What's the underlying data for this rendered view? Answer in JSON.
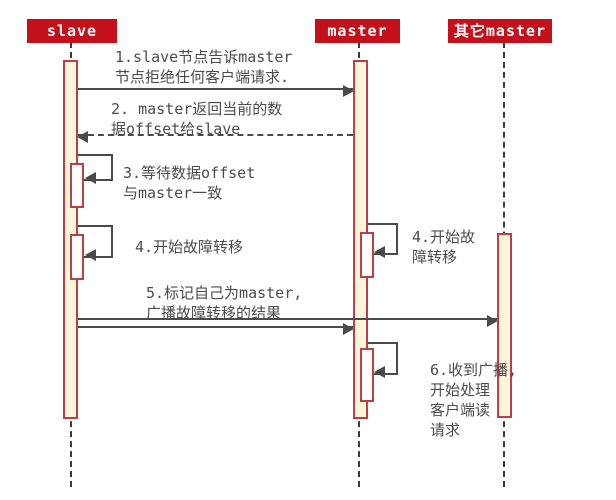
{
  "diagram": {
    "kind": "uml-sequence-diagram",
    "topic": "redis-failover"
  },
  "participants": [
    {
      "label": "slave"
    },
    {
      "label": "master"
    },
    {
      "label": "其它master"
    }
  ],
  "messages": {
    "m1": "1.slave节点告诉master\n节点拒绝任何客户端请求.",
    "m2": "2. master返回当前的数\n据offset给slave",
    "m3": "3.等待数据offset\n与master一致",
    "m4_slave": "4.开始故障转移",
    "m4_master": "4.开始故\n障转移",
    "m5": "5.标记自己为master,\n广播故障转移的结果",
    "m6": "6.收到广播,\n开始处理\n客户端读\n请求"
  },
  "colors": {
    "header_bg": "#c4101a",
    "header_text": "#ffffff",
    "activation_fill": "#fbf5dc",
    "activation_border": "#bd3e44",
    "line": "#4a4a4a",
    "lifeline": "#3a3a3a",
    "text": "#4c4c4c",
    "canvas_bg": "#ffffff"
  }
}
